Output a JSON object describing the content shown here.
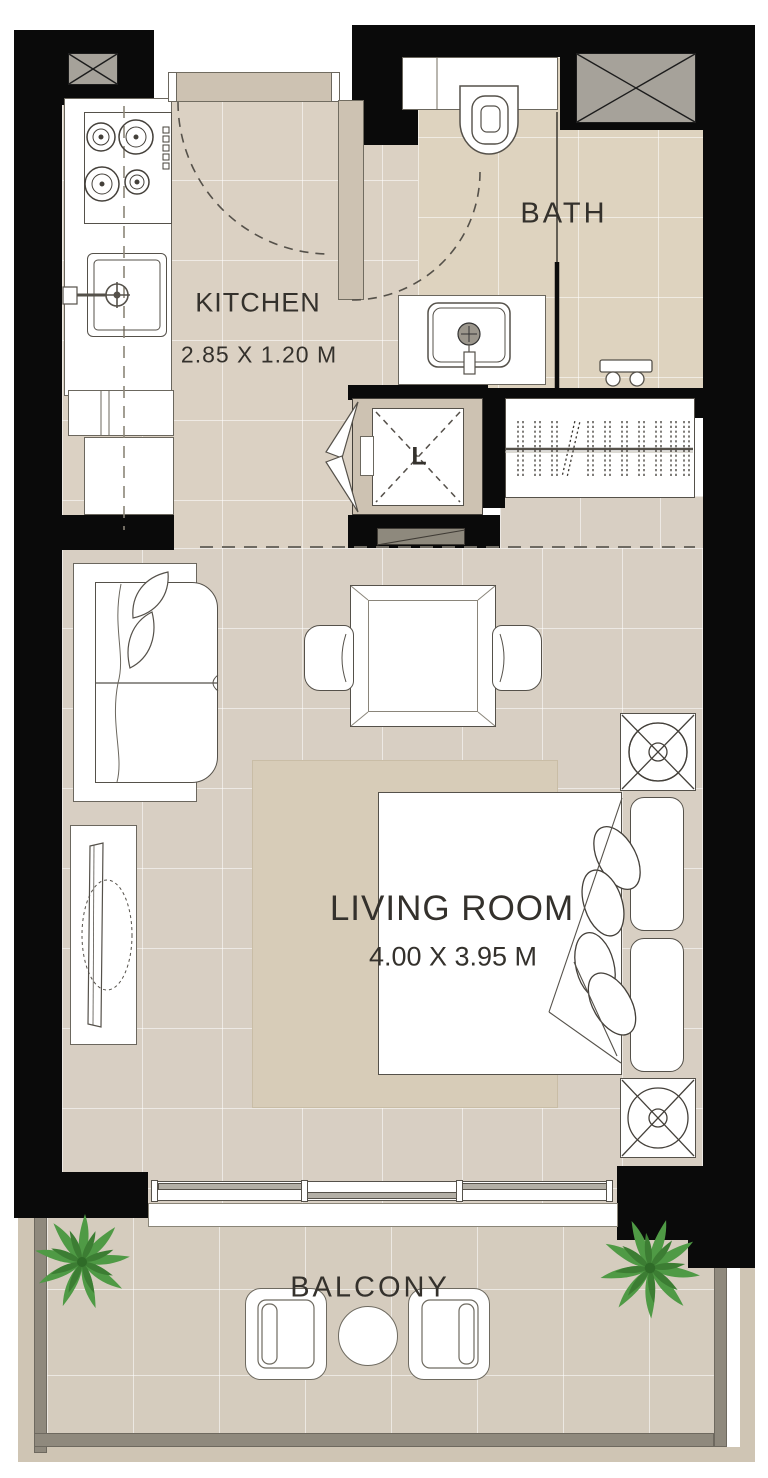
{
  "plan_title": "Studio Unit Floor Plan",
  "rooms": {
    "kitchen": {
      "label": "KITCHEN",
      "dimensions": "2.85 X 1.20 M",
      "fixtures": [
        "cooktop",
        "kitchen-sink",
        "counter",
        "cabinets",
        "entry-door"
      ]
    },
    "bath": {
      "label": "BATH",
      "fixtures": [
        "toilet",
        "bathroom-sink",
        "shower-partition",
        "shower-stool",
        "bath-door"
      ]
    },
    "shaft": {
      "label": "L",
      "fixtures": [
        "bifold-door"
      ]
    },
    "closet": {
      "fixtures": [
        "wardrobe-rail",
        "hangers"
      ]
    },
    "living": {
      "label": "LIVING ROOM",
      "dimensions": "4.00 X 3.95 M",
      "fixtures": [
        "sofa",
        "tv-console",
        "dining-table",
        "dining-chairs",
        "rug",
        "bed",
        "pillows",
        "nightstand-lamps",
        "sliding-door"
      ]
    },
    "balcony": {
      "label": "BALCONY",
      "fixtures": [
        "armchairs",
        "round-table",
        "plants"
      ]
    }
  },
  "colors": {
    "wall": "#0a0a0a",
    "kitchen_floor": "#dbd1c3",
    "bath_floor": "#ded3bf",
    "living_floor": "#d8cfc3",
    "balcony_floor": "#d5ccbe",
    "rug": "#d7ccb8",
    "door_leaf": "#cdc2b2",
    "duct_shaft": "#a6a29a",
    "balcony_wall": "#8f897d",
    "plant_green": "#4f9a45",
    "text": "#34312c"
  }
}
